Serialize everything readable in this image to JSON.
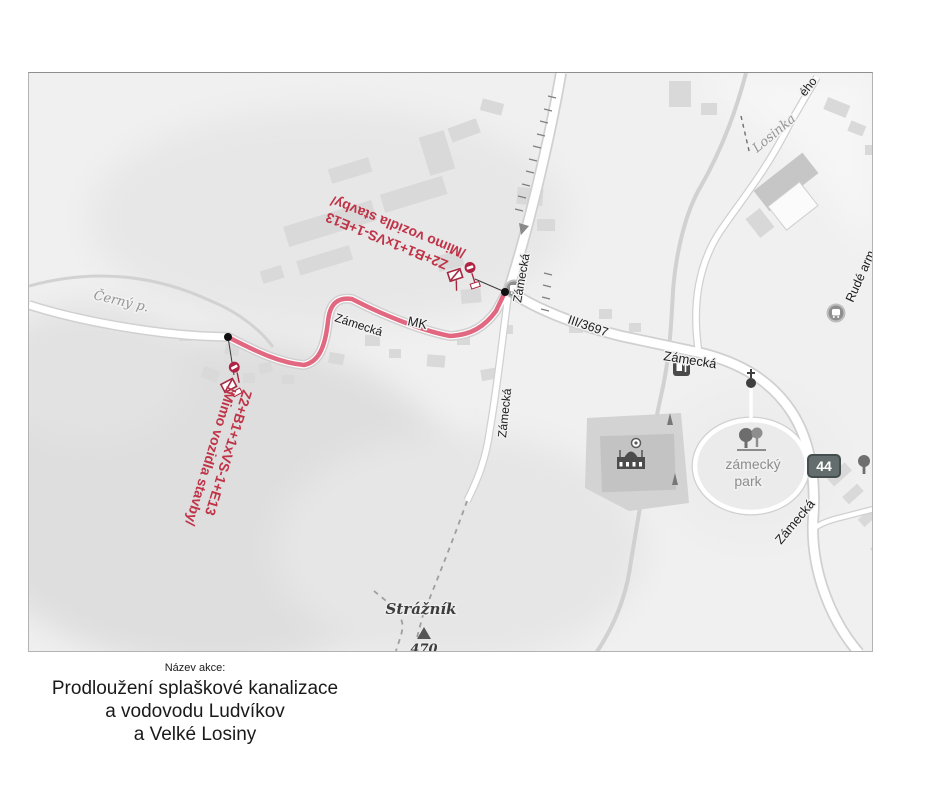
{
  "map": {
    "background": "#f0f0f0",
    "route_color": "#e0607a",
    "annotation_color": "#c03347",
    "sign_color": "#a82740",
    "badge_color": "#646d6d",
    "annotation": {
      "formula": "Z2+B1+1xVS-1+E13",
      "note": "/Mimo vozidla stavby/"
    },
    "labels": {
      "road_number": "III/3697",
      "local_road": "MK",
      "zamecka": "Zámecká",
      "rude_armady": "Rudé arm",
      "eho": "ého",
      "losinka": "Losinka",
      "cerny_potok": "Černý p.",
      "park_line1": "zámecký",
      "park_line2": "park",
      "hill": "Strážník",
      "elevation": "470",
      "badge": "44"
    },
    "icons": {
      "bus_stop": "bus-stop",
      "restaurant": "restaurant",
      "monument": "cross-monument",
      "castle": "castle",
      "park_trees": "park-trees",
      "tree": "tree",
      "peak": "mountain-peak",
      "traffic_signs": "construction-traffic-signs"
    }
  },
  "caption": {
    "heading": "Název akce:",
    "line1": "Prodloužení splaškové kanalizace",
    "line2": "a vodovodu Ludvíkov",
    "line3": "a Velké Losiny"
  }
}
